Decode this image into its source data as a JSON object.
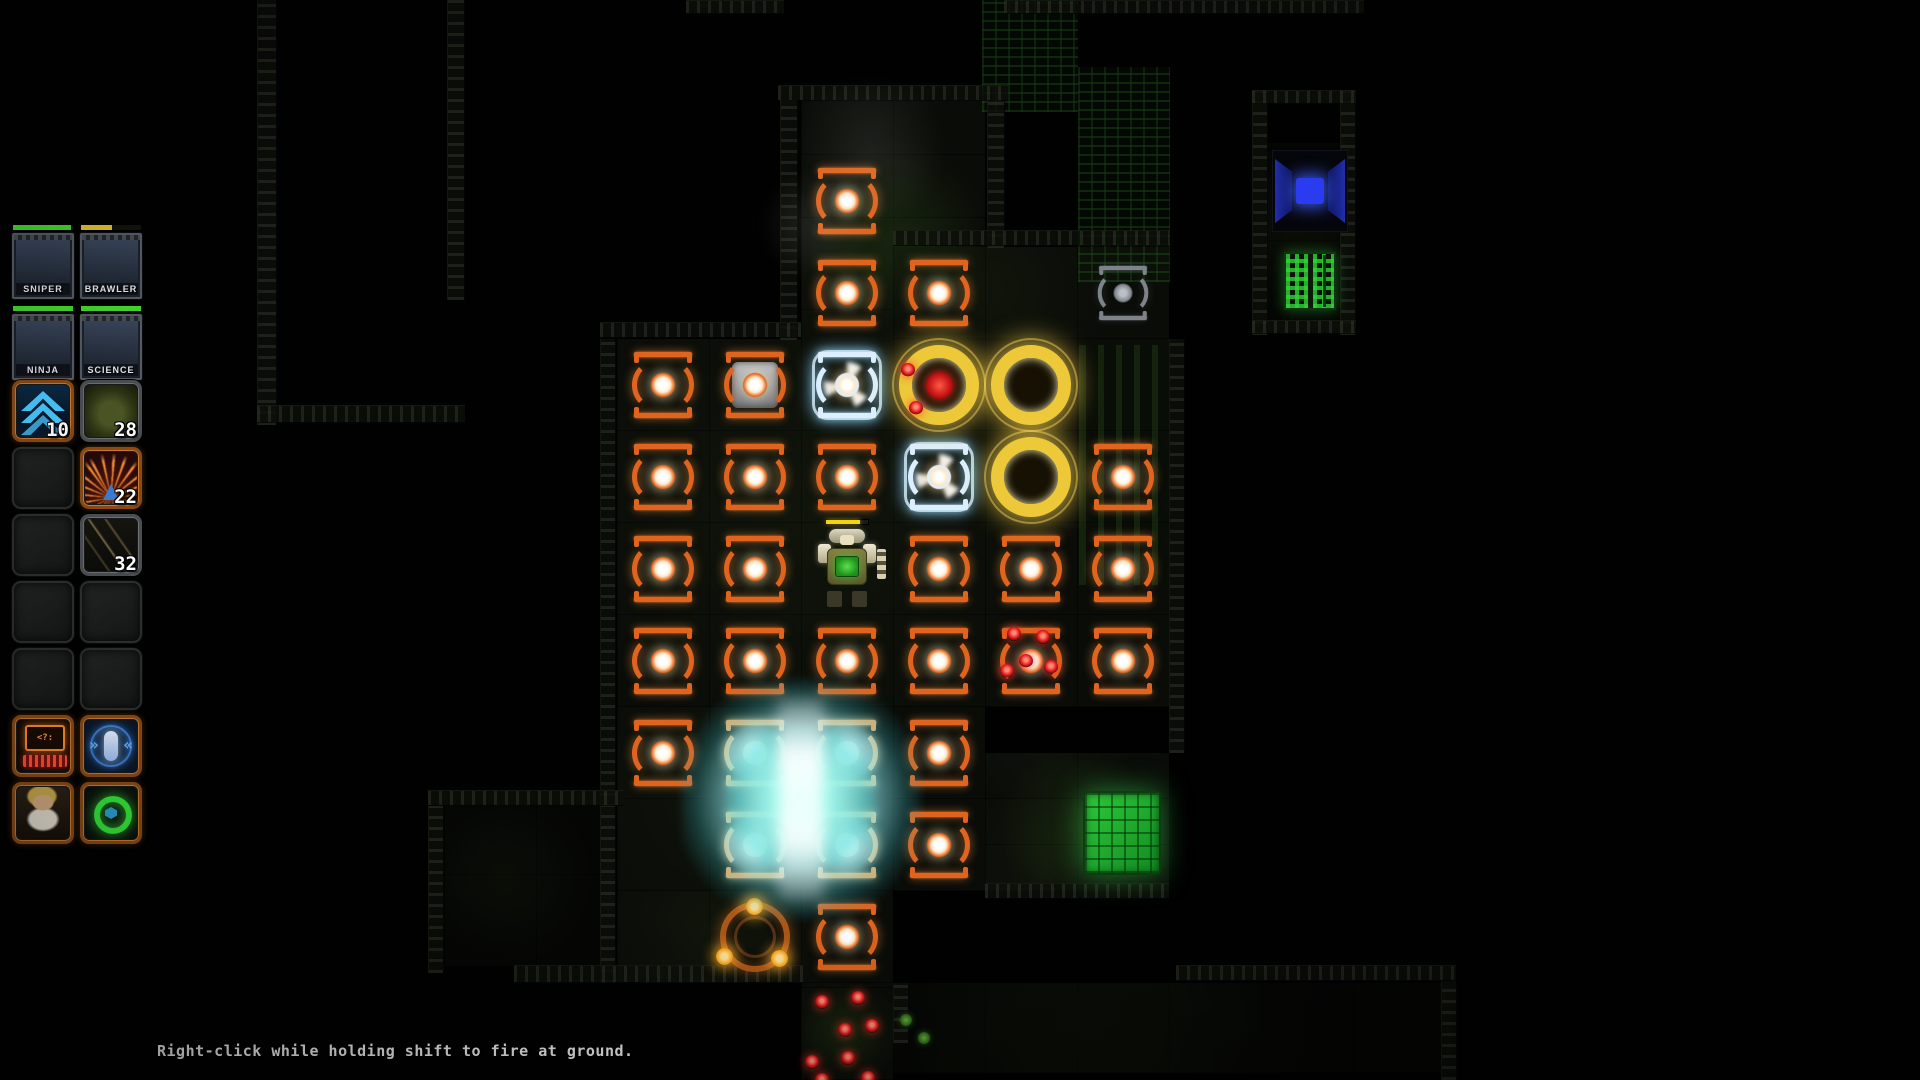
{
  "hint": {
    "text": "Right-click while holding shift to fire at ground."
  },
  "party": [
    {
      "name": "SNIPER",
      "hp_pct": 97,
      "hp_color": "#44d62c",
      "art": "green-mech"
    },
    {
      "name": "BRAWLER",
      "hp_pct": 52,
      "hp_color": "#e3bf2a",
      "art": "red-mech"
    },
    {
      "name": "NINJA",
      "hp_pct": 100,
      "hp_color": "#44d62c",
      "art": "dark-mech"
    },
    {
      "name": "SCIENCE",
      "hp_pct": 100,
      "hp_color": "#44d62c",
      "art": "purple-mech"
    }
  ],
  "hotbar": {
    "screen_text": "<?:",
    "targeting_glyphs": {
      "left": "»",
      "right": "«"
    },
    "slots": [
      {
        "r": 0,
        "c": 0,
        "kind": "jump",
        "label": "10",
        "frame": "orange"
      },
      {
        "r": 0,
        "c": 1,
        "kind": "armor",
        "label": "28",
        "frame": "grey"
      },
      {
        "r": 1,
        "c": 0,
        "kind": "empty"
      },
      {
        "r": 1,
        "c": 1,
        "kind": "flame",
        "label": "22",
        "frame": "orange"
      },
      {
        "r": 2,
        "c": 0,
        "kind": "empty"
      },
      {
        "r": 2,
        "c": 1,
        "kind": "shrapnel",
        "label": "32",
        "frame": "grey"
      },
      {
        "r": 3,
        "c": 0,
        "kind": "empty"
      },
      {
        "r": 3,
        "c": 1,
        "kind": "empty"
      },
      {
        "r": 4,
        "c": 0,
        "kind": "empty"
      },
      {
        "r": 4,
        "c": 1,
        "kind": "empty"
      },
      {
        "r": 5,
        "c": 0,
        "kind": "terminal",
        "frame": "orange"
      },
      {
        "r": 5,
        "c": 1,
        "kind": "targeting",
        "frame": "orange"
      },
      {
        "r": 6,
        "c": 0,
        "kind": "portrait",
        "frame": "orange"
      },
      {
        "r": 6,
        "c": 1,
        "kind": "recycle",
        "frame": "orange"
      }
    ]
  },
  "map": {
    "grid": {
      "x": 617,
      "y": 155,
      "cell": 92
    },
    "turrets": [
      {
        "c": 2,
        "r": 0,
        "v": "orange"
      },
      {
        "c": 2,
        "r": 1,
        "v": "orange"
      },
      {
        "c": 3,
        "r": 1,
        "v": "orange"
      },
      {
        "c": 5,
        "r": 1,
        "v": "grey"
      },
      {
        "c": 0,
        "r": 2,
        "v": "orange"
      },
      {
        "c": 1,
        "r": 2,
        "v": "boxed"
      },
      {
        "c": 2,
        "r": 2,
        "v": "cyan"
      },
      {
        "c": 0,
        "r": 3,
        "v": "orange"
      },
      {
        "c": 1,
        "r": 3,
        "v": "orange"
      },
      {
        "c": 2,
        "r": 3,
        "v": "orange"
      },
      {
        "c": 3,
        "r": 3,
        "v": "cyan"
      },
      {
        "c": 5,
        "r": 3,
        "v": "orange"
      },
      {
        "c": 0,
        "r": 4,
        "v": "orange"
      },
      {
        "c": 1,
        "r": 4,
        "v": "orange"
      },
      {
        "c": 3,
        "r": 4,
        "v": "orange"
      },
      {
        "c": 4,
        "r": 4,
        "v": "orange"
      },
      {
        "c": 5,
        "r": 4,
        "v": "orange"
      },
      {
        "c": 0,
        "r": 5,
        "v": "orange"
      },
      {
        "c": 1,
        "r": 5,
        "v": "orange"
      },
      {
        "c": 2,
        "r": 5,
        "v": "orange"
      },
      {
        "c": 3,
        "r": 5,
        "v": "orange"
      },
      {
        "c": 4,
        "r": 5,
        "v": "orange"
      },
      {
        "c": 5,
        "r": 5,
        "v": "orange"
      },
      {
        "c": 0,
        "r": 6,
        "v": "orange"
      },
      {
        "c": 3,
        "r": 6,
        "v": "orange"
      },
      {
        "c": 3,
        "r": 7,
        "v": "orange"
      },
      {
        "c": 2,
        "r": 8,
        "v": "orange"
      }
    ],
    "glow_turrets": [
      {
        "c": 1,
        "r": 6
      },
      {
        "c": 2,
        "r": 6
      },
      {
        "c": 1,
        "r": 7
      },
      {
        "c": 2,
        "r": 7
      }
    ],
    "yellow_rings": [
      {
        "c": 3,
        "r": 2,
        "red_core": true
      },
      {
        "c": 4,
        "r": 2
      },
      {
        "c": 4,
        "r": 3
      }
    ],
    "spawn_ring": {
      "c": 1,
      "r": 8
    },
    "player_mech": {
      "c": 2,
      "r": 4
    },
    "energy_structure": {
      "x": 709,
      "y": 707,
      "w": 184,
      "h": 184
    },
    "green_door": {
      "x": 1083,
      "y": 791,
      "w": 78,
      "h": 84
    },
    "blue_console": {
      "x": 1272,
      "y": 150,
      "w": 76,
      "h": 82
    },
    "circuit_panel": {
      "x": 1284,
      "y": 252,
      "w": 52,
      "h": 58
    },
    "red_blips": [
      [
        908,
        370
      ],
      [
        916,
        408
      ],
      [
        1014,
        634
      ],
      [
        1043,
        637
      ],
      [
        1026,
        661
      ],
      [
        1051,
        667
      ],
      [
        1007,
        671
      ],
      [
        822,
        1002
      ],
      [
        858,
        998
      ],
      [
        845,
        1030
      ],
      [
        872,
        1026
      ],
      [
        812,
        1062
      ],
      [
        848,
        1058
      ],
      [
        868,
        1078
      ],
      [
        822,
        1080
      ]
    ]
  },
  "colors": {
    "turret_orange": "#e0641e",
    "ring_yellow": "#edc93a",
    "blip_red": "#e41c1c",
    "energy_cyan": "#bfffff",
    "door_green": "#25c231"
  }
}
